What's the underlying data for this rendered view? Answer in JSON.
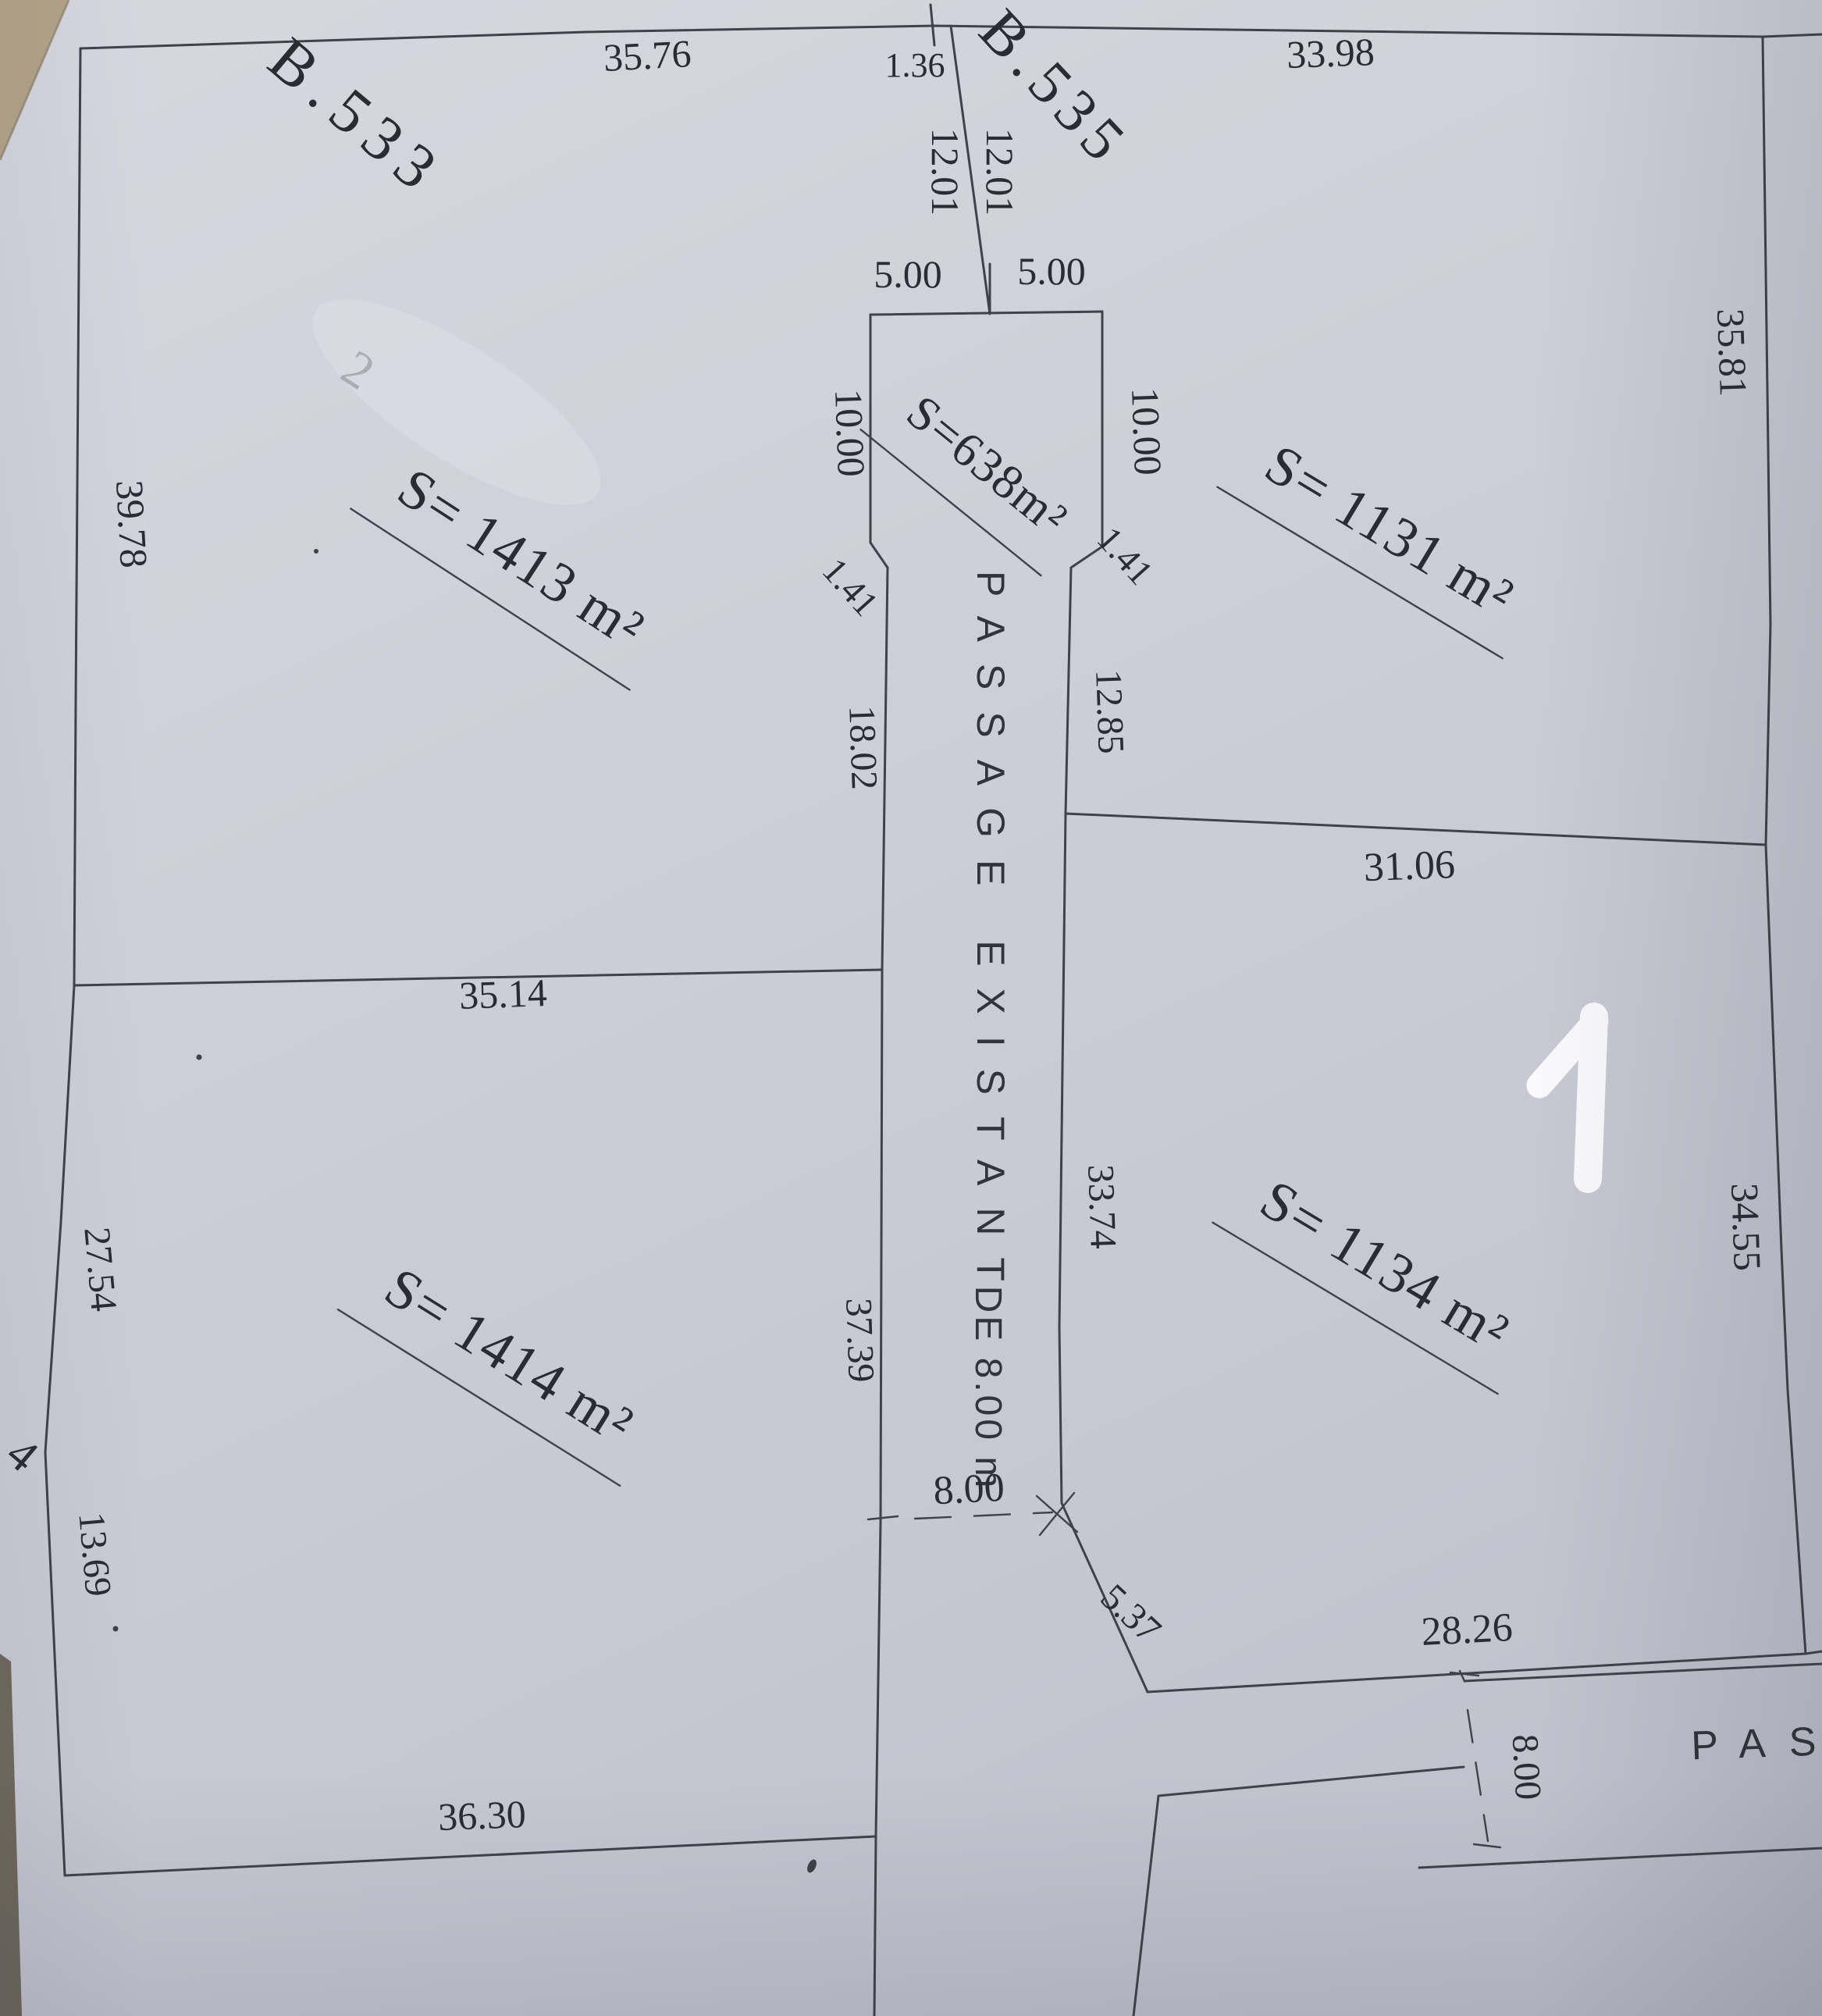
{
  "document": {
    "parcels": {
      "left_block": "B.533",
      "middle_block": "B.535"
    },
    "areas": {
      "left_top": "S= 1413 m²",
      "left_bottom": "S= 1414 m²",
      "funnel": "S=638m²",
      "right_top": "S= 1131 m²",
      "right_bottom": "S= 1134 m²"
    },
    "passage": {
      "name": "PASSAGE EXISTANT",
      "width_text": "DE 8.00 m",
      "right_passage_partial": "PAS"
    },
    "dimensions": {
      "top_left": "35.76",
      "offset": "1.36",
      "division_left": "12.01",
      "division_right": "12.01",
      "funnel_top_left": "5.00",
      "funnel_top_right": "5.00",
      "top_right": "33.98",
      "right_upper": "35.81",
      "funnel_left": "10.00",
      "funnel_right": "10.00",
      "chamfer_left": "1.41",
      "chamfer_right": "1.41",
      "left_upper": "39.78",
      "strip_left_upper": "18.02",
      "strip_right_upper": "12.85",
      "mid_left": "35.14",
      "mid_right": "31.06",
      "strip_right_lower": "33.74",
      "strip_left_lower": "37.39",
      "right_lower": "34.55",
      "left_middle": "27.54",
      "exit_width": "8.00",
      "exit_chamfer": "5.37",
      "bottom_right": "28.26",
      "side_passage_width": "8.00",
      "left_lower": "13.69",
      "bottom": "36.30",
      "neighbor_partial": "4"
    },
    "annotations": {
      "erased_faint": "2",
      "white_marker": "1"
    }
  }
}
